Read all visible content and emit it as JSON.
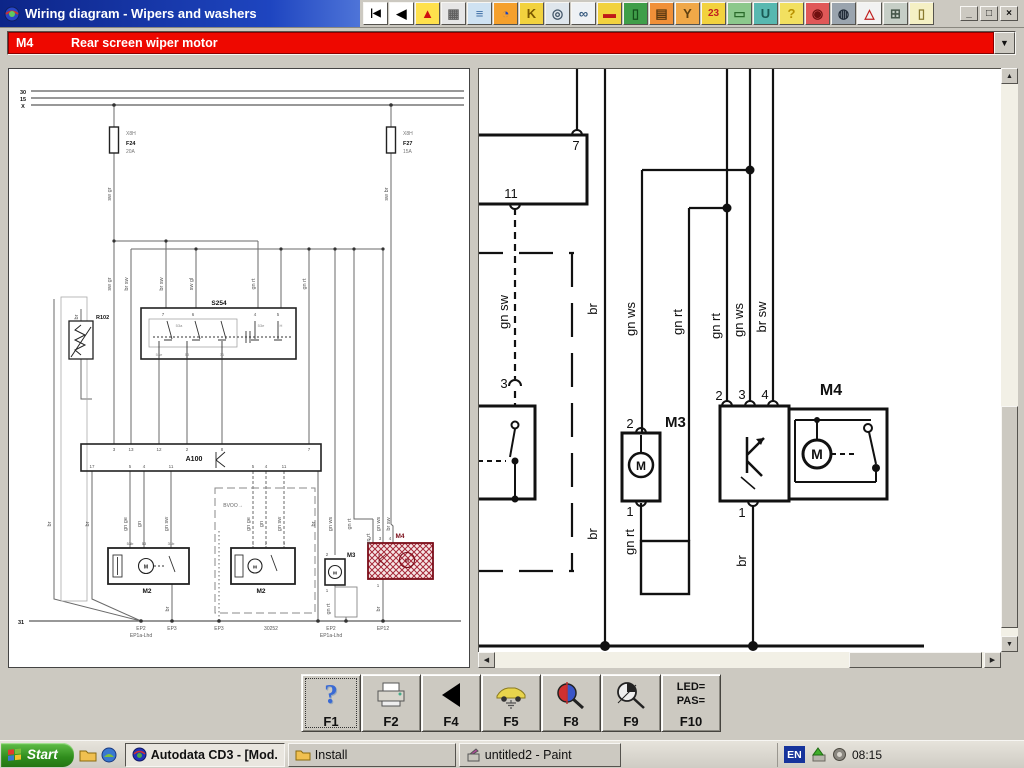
{
  "window": {
    "title": "Wiring diagram - Wipers and washers",
    "controls": [
      {
        "name": "minimize-button",
        "glyph": "_"
      },
      {
        "name": "maximize-button",
        "glyph": "□"
      },
      {
        "name": "close-button",
        "glyph": "×"
      }
    ]
  },
  "top_toolbar": {
    "buttons": [
      {
        "name": "first-page-button",
        "glyph": "|◀",
        "bg": "#ffffff",
        "fg": "#000000"
      },
      {
        "name": "back-button",
        "glyph": "◀",
        "bg": "#ffffff",
        "fg": "#000000"
      },
      {
        "name": "warning-icon",
        "glyph": "▲",
        "bg": "#ffe14d",
        "fg": "#d01010"
      },
      {
        "name": "window-panels-icon",
        "glyph": "▦",
        "bg": "#e6e6e6",
        "fg": "#606060"
      },
      {
        "name": "hoist-icon",
        "glyph": "≡",
        "bg": "#cfe2f2",
        "fg": "#3c6ea5"
      },
      {
        "name": "timing-globe-icon",
        "glyph": "◔",
        "bg": "#f5a02c",
        "fg": "#1c43c0"
      },
      {
        "name": "key-programming-icon",
        "glyph": "K",
        "bg": "#f2d23e",
        "fg": "#7a5800"
      },
      {
        "name": "wheel-icon",
        "glyph": "◎",
        "bg": "#dfe6ec",
        "fg": "#45586a"
      },
      {
        "name": "mirrors-icon",
        "glyph": "∞",
        "bg": "#eef1f4",
        "fg": "#35597e"
      },
      {
        "name": "bodywork-icon",
        "glyph": "▬",
        "bg": "#f2d23e",
        "fg": "#c01818"
      },
      {
        "name": "door-lift-icon",
        "glyph": "▯",
        "bg": "#3f9e49",
        "fg": "#14511b"
      },
      {
        "name": "truck-icon",
        "glyph": "▤",
        "bg": "#f09038",
        "fg": "#5c3a10"
      },
      {
        "name": "key-fob-icon",
        "glyph": "Y",
        "bg": "#f0a848",
        "fg": "#604010"
      },
      {
        "name": "service-intervals-icon",
        "glyph": "23",
        "bg": "#f2d23e",
        "fg": "#c02020"
      },
      {
        "name": "printer-icon",
        "glyph": "▭",
        "bg": "#8cc88c",
        "fg": "#2a6a2a"
      },
      {
        "name": "oil-can-icon",
        "glyph": "U",
        "bg": "#58b8b0",
        "fg": "#1a5a55"
      },
      {
        "name": "help-car-icon",
        "glyph": "?",
        "bg": "#f2e060",
        "fg": "#b89000"
      },
      {
        "name": "airbag-icon",
        "glyph": "◉",
        "bg": "#e05858",
        "fg": "#701010"
      },
      {
        "name": "abs-wheel-icon",
        "glyph": "◍",
        "bg": "#9aa4ae",
        "fg": "#222c38"
      },
      {
        "name": "abs-warning-icon",
        "glyph": "△",
        "bg": "#f2f2f2",
        "fg": "#c02020"
      },
      {
        "name": "engine-icon",
        "glyph": "⊞",
        "bg": "#c6cec6",
        "fg": "#46564a"
      },
      {
        "name": "door-switch-icon",
        "glyph": "▯",
        "bg": "#f5f0c4",
        "fg": "#8a7a30"
      }
    ]
  },
  "selector": {
    "code": "M4",
    "label": "Rear screen wiper motor"
  },
  "overview_labels": [
    {
      "t": "30",
      "x": 14,
      "y": 25,
      "b": 1
    },
    {
      "t": "15",
      "x": 14,
      "y": 32,
      "b": 1
    },
    {
      "t": "X",
      "x": 14,
      "y": 39,
      "b": 1
    },
    {
      "t": "X8H",
      "x": 117,
      "y": 66,
      "a": "s",
      "c": "#777",
      "fs": 5
    },
    {
      "t": "F24",
      "x": 117,
      "y": 76,
      "a": "s",
      "b": 1
    },
    {
      "t": "20A",
      "x": 117,
      "y": 84,
      "a": "s",
      "c": "#777",
      "fs": 5
    },
    {
      "t": "X8H",
      "x": 394,
      "y": 66,
      "a": "s",
      "c": "#777",
      "fs": 5
    },
    {
      "t": "F27",
      "x": 394,
      "y": 76,
      "a": "s",
      "b": 1
    },
    {
      "t": "15A",
      "x": 394,
      "y": 84,
      "a": "s",
      "c": "#777",
      "fs": 5
    },
    {
      "t": "sw gr",
      "x": 102,
      "y": 125,
      "r": 1
    },
    {
      "t": "sw br",
      "x": 379,
      "y": 125,
      "r": 1
    },
    {
      "t": "sw gr",
      "x": 102,
      "y": 215,
      "r": 1
    },
    {
      "t": "br sw",
      "x": 119,
      "y": 215,
      "r": 1
    },
    {
      "t": "br sw",
      "x": 154,
      "y": 215,
      "r": 1
    },
    {
      "t": "sw gl",
      "x": 184,
      "y": 215,
      "r": 1
    },
    {
      "t": "gn rt",
      "x": 246,
      "y": 215,
      "r": 1
    },
    {
      "t": "gn rt",
      "x": 297,
      "y": 215,
      "r": 1
    },
    {
      "t": "br",
      "x": 69,
      "y": 248,
      "r": 1
    },
    {
      "t": "S254",
      "x": 210,
      "y": 236,
      "b": 1,
      "fs": 6.5
    },
    {
      "t": "7",
      "x": 154,
      "y": 247,
      "fs": 4.5
    },
    {
      "t": "6",
      "x": 184,
      "y": 247,
      "fs": 4.5
    },
    {
      "t": "4",
      "x": 246,
      "y": 247,
      "fs": 4.5
    },
    {
      "t": "5",
      "x": 269,
      "y": 247,
      "fs": 4.5
    },
    {
      "t": "53a",
      "x": 170,
      "y": 258,
      "fs": 4,
      "c": "#888"
    },
    {
      "t": "53e",
      "x": 252,
      "y": 258,
      "fs": 4,
      "c": "#888"
    },
    {
      "t": "H",
      "x": 272,
      "y": 258,
      "fs": 4,
      "c": "#888"
    },
    {
      "t": "53e",
      "x": 150,
      "y": 287,
      "fs": 4,
      "c": "#888"
    },
    {
      "t": "53",
      "x": 178,
      "y": 287,
      "fs": 4,
      "c": "#888"
    },
    {
      "t": "31",
      "x": 213,
      "y": 287,
      "fs": 4,
      "c": "#888"
    },
    {
      "t": "R102",
      "x": 87,
      "y": 250,
      "b": 1,
      "a": "s"
    },
    {
      "t": "A100",
      "x": 185,
      "y": 392,
      "b": 1,
      "fs": 7
    },
    {
      "t": "3",
      "x": 105,
      "y": 382,
      "fs": 4.5
    },
    {
      "t": "13",
      "x": 122,
      "y": 382,
      "fs": 4.5
    },
    {
      "t": "12",
      "x": 150,
      "y": 382,
      "fs": 4.5
    },
    {
      "t": "2",
      "x": 178,
      "y": 382,
      "fs": 4.5
    },
    {
      "t": "8",
      "x": 213,
      "y": 382,
      "fs": 4.5
    },
    {
      "t": "7",
      "x": 300,
      "y": 382,
      "fs": 4.5
    },
    {
      "t": "17",
      "x": 83,
      "y": 399,
      "fs": 4.5
    },
    {
      "t": "5",
      "x": 121,
      "y": 399,
      "fs": 4.5
    },
    {
      "t": "4",
      "x": 135,
      "y": 399,
      "fs": 4.5
    },
    {
      "t": "11",
      "x": 162,
      "y": 399,
      "fs": 4.5
    },
    {
      "t": "5",
      "x": 244,
      "y": 399,
      "fs": 4.5
    },
    {
      "t": "4",
      "x": 257,
      "y": 399,
      "fs": 4.5
    },
    {
      "t": "11",
      "x": 275,
      "y": 399,
      "fs": 4.5
    },
    {
      "t": "br",
      "x": 42,
      "y": 455,
      "r": 1
    },
    {
      "t": "br",
      "x": 80,
      "y": 455,
      "r": 1
    },
    {
      "t": "gn ge",
      "x": 118,
      "y": 455,
      "r": 1
    },
    {
      "t": "gn",
      "x": 132,
      "y": 455,
      "r": 1
    },
    {
      "t": "gn sw",
      "x": 159,
      "y": 455,
      "r": 1
    },
    {
      "t": "BVOO→",
      "x": 224,
      "y": 438,
      "fs": 5,
      "c": "#666"
    },
    {
      "t": "gn ge",
      "x": 241,
      "y": 455,
      "r": 1
    },
    {
      "t": "gn",
      "x": 254,
      "y": 455,
      "r": 1
    },
    {
      "t": "gn sw",
      "x": 272,
      "y": 455,
      "r": 1
    },
    {
      "t": "br",
      "x": 306,
      "y": 455,
      "r": 1
    },
    {
      "t": "gn ws",
      "x": 323,
      "y": 455,
      "r": 1
    },
    {
      "t": "gn rt",
      "x": 342,
      "y": 455,
      "r": 1
    },
    {
      "t": "gn rt",
      "x": 361,
      "y": 470,
      "r": 1
    },
    {
      "t": "gn ws",
      "x": 371,
      "y": 455,
      "r": 1
    },
    {
      "t": "br sw",
      "x": 381,
      "y": 455,
      "r": 1
    },
    {
      "t": "53b",
      "x": 121,
      "y": 476,
      "fs": 4
    },
    {
      "t": "53",
      "x": 135,
      "y": 476,
      "fs": 4
    },
    {
      "t": "31b",
      "x": 162,
      "y": 476,
      "fs": 4
    },
    {
      "t": "1",
      "x": 244,
      "y": 476,
      "fs": 4
    },
    {
      "t": "2",
      "x": 257,
      "y": 476,
      "fs": 4
    },
    {
      "t": "3",
      "x": 275,
      "y": 476,
      "fs": 4
    },
    {
      "t": "M",
      "x": 137,
      "y": 499.5,
      "fs": 5,
      "b": 1
    },
    {
      "t": "M",
      "x": 246,
      "y": 499.5,
      "fs": 4.5,
      "b": 1
    },
    {
      "t": "M2",
      "x": 138,
      "y": 524,
      "b": 1,
      "fs": 6.5
    },
    {
      "t": "M2",
      "x": 252,
      "y": 524,
      "b": 1,
      "fs": 6.5
    },
    {
      "t": "M3",
      "x": 338,
      "y": 488,
      "b": 1,
      "fs": 6,
      "a": "s"
    },
    {
      "t": "2",
      "x": 318,
      "y": 487,
      "fs": 4.5
    },
    {
      "t": "1",
      "x": 318,
      "y": 523,
      "fs": 4.5
    },
    {
      "t": "M",
      "x": 326,
      "y": 505.5,
      "fs": 4.5,
      "b": 1
    },
    {
      "t": "gn rt",
      "x": 321,
      "y": 540,
      "r": 1
    },
    {
      "t": "br",
      "x": 160,
      "y": 540,
      "r": 1
    },
    {
      "t": "br",
      "x": 371,
      "y": 540,
      "r": 1
    },
    {
      "t": "M4",
      "x": 391,
      "y": 469,
      "b": 1,
      "fs": 6.5,
      "c": "#7a0c18"
    },
    {
      "t": "2",
      "x": 361,
      "y": 471,
      "fs": 4.5
    },
    {
      "t": "3",
      "x": 371,
      "y": 471,
      "fs": 4.5
    },
    {
      "t": "4",
      "x": 381,
      "y": 471,
      "fs": 4.5
    },
    {
      "t": "1",
      "x": 369,
      "y": 518,
      "fs": 4.5
    },
    {
      "t": "M",
      "x": 398,
      "y": 493.5,
      "fs": 5,
      "b": 1,
      "c": "#7a0c18"
    },
    {
      "t": "31",
      "x": 12,
      "y": 555,
      "b": 1
    },
    {
      "t": "EP2",
      "x": 132,
      "y": 561,
      "fs": 5,
      "c": "#555"
    },
    {
      "t": "EP1a-Lhd",
      "x": 132,
      "y": 568,
      "fs": 5,
      "c": "#555"
    },
    {
      "t": "EP3",
      "x": 163,
      "y": 561,
      "fs": 5,
      "c": "#555"
    },
    {
      "t": "EP3",
      "x": 210,
      "y": 561,
      "fs": 5,
      "c": "#555"
    },
    {
      "t": "30252",
      "x": 262,
      "y": 561,
      "fs": 5,
      "c": "#555"
    },
    {
      "t": "EP2",
      "x": 322,
      "y": 561,
      "fs": 5,
      "c": "#555"
    },
    {
      "t": "EP1a-Lhd",
      "x": 322,
      "y": 568,
      "fs": 5,
      "c": "#555"
    },
    {
      "t": "EP12",
      "x": 374,
      "y": 561,
      "fs": 5,
      "c": "#555"
    }
  ],
  "detail_labels": [
    {
      "t": "7",
      "x": 97,
      "y": 81
    },
    {
      "t": "11",
      "x": 32,
      "y": 129
    },
    {
      "t": "gn sw",
      "x": 29,
      "y": 243,
      "r": 1
    },
    {
      "t": "3",
      "x": 25,
      "y": 319
    },
    {
      "t": "br",
      "x": 118,
      "y": 240,
      "r": 1
    },
    {
      "t": "br",
      "x": 118,
      "y": 465,
      "r": 1
    },
    {
      "t": "gn ws",
      "x": 156,
      "y": 250,
      "r": 1
    },
    {
      "t": "gn rt",
      "x": 203,
      "y": 253,
      "r": 1
    },
    {
      "t": "gn rt",
      "x": 241,
      "y": 257,
      "r": 1
    },
    {
      "t": "gn ws",
      "x": 264,
      "y": 251,
      "r": 1
    },
    {
      "t": "br sw",
      "x": 287,
      "y": 248,
      "r": 1
    },
    {
      "t": "2",
      "x": 151,
      "y": 359
    },
    {
      "t": "M3",
      "x": 186,
      "y": 358,
      "b": 1,
      "fs": 15,
      "a": "s"
    },
    {
      "t": "M",
      "x": 162,
      "y": 401,
      "b": 1,
      "fs": 12
    },
    {
      "t": "1",
      "x": 151,
      "y": 447
    },
    {
      "t": "gn rt",
      "x": 155,
      "y": 473,
      "r": 1
    },
    {
      "t": "2",
      "x": 240,
      "y": 331
    },
    {
      "t": "3",
      "x": 263,
      "y": 330
    },
    {
      "t": "4",
      "x": 286,
      "y": 330
    },
    {
      "t": "M4",
      "x": 352,
      "y": 326,
      "b": 1,
      "fs": 16
    },
    {
      "t": "M",
      "x": 338,
      "y": 390,
      "b": 1,
      "fs": 14
    },
    {
      "t": "1",
      "x": 263,
      "y": 448
    },
    {
      "t": "br",
      "x": 267,
      "y": 492,
      "r": 1
    },
    {
      "t": "EP2",
      "x": 126,
      "y": 591,
      "fs": 12
    },
    {
      "t": "EP12",
      "x": 274,
      "y": 591,
      "fs": 12
    }
  ],
  "function_bar": {
    "buttons": [
      {
        "key": "F1",
        "icon": "help-icon",
        "focused": true
      },
      {
        "key": "F2",
        "icon": "print-icon"
      },
      {
        "key": "F4",
        "icon": "back-icon"
      },
      {
        "key": "F5",
        "icon": "vehicle-earth-icon"
      },
      {
        "key": "F8",
        "icon": "component-search-icon"
      },
      {
        "key": "F9",
        "icon": "earth-point-search-icon"
      },
      {
        "key": "F10",
        "icon": "led-pas-icon",
        "line1": "LED=",
        "line2": "PAS="
      }
    ]
  },
  "taskbar": {
    "start_label": "Start",
    "quick_launch": [
      {
        "name": "folder-quicklaunch-icon"
      },
      {
        "name": "desktop-quicklaunch-icon"
      }
    ],
    "tasks": [
      {
        "label": "Autodata CD3 - [Mod...",
        "icon": "autodata-icon",
        "active": true,
        "width": 160
      },
      {
        "label": "Install",
        "icon": "folder-icon",
        "active": false,
        "width": 168
      },
      {
        "label": "untitled2 - Paint",
        "icon": "paint-icon",
        "active": false,
        "width": 162
      }
    ],
    "tray": {
      "language": "EN",
      "time": "08:15",
      "icons": [
        "eject-hardware-icon",
        "volume-icon"
      ]
    }
  }
}
